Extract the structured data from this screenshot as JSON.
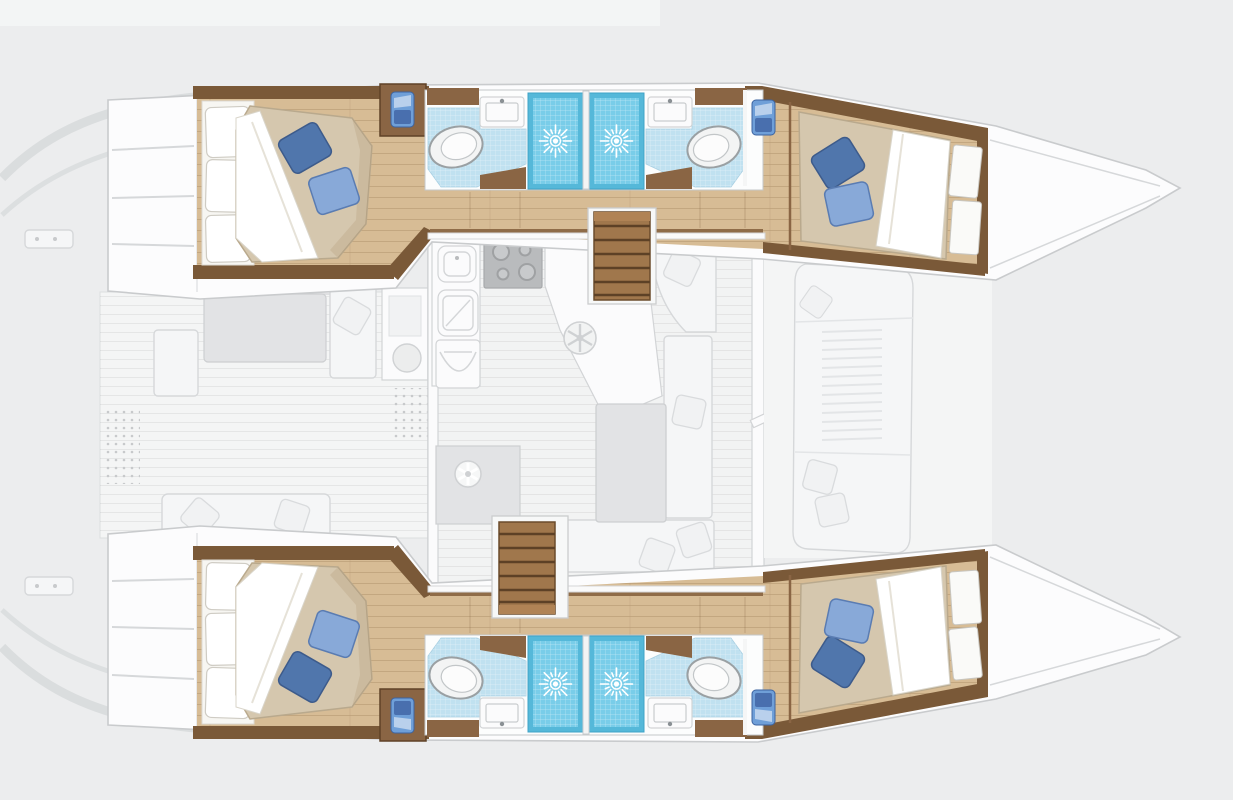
{
  "title": "Catamaran yacht floor plan",
  "palette": {
    "background": "#ecedee",
    "hull_white": "#fcfcfd",
    "hull_outline": "#c9cbcd",
    "ghost_fill": "#f5f6f7",
    "ghost_stroke": "#d6d8da",
    "ghost_dark": "#e2e3e5",
    "wood_floor": "#d7bc95",
    "wood_plank": "#a9835c",
    "wall_wood": "#7a5938",
    "cabinet_wood": "#8a6544",
    "stair_wood": "#a0774c",
    "stair_tread": "#5d4126",
    "mattress": "#d5c7ae",
    "mattress_edge": "#b9a98d",
    "sheet_white": "#ffffff",
    "pillow_dark_blue": "#5076ac",
    "pillow_light_blue": "#88a9d8",
    "bath_floor_blue": "#c0e1f0",
    "shower_blue": "#55b8d9",
    "shower_blue_light": "#79cde9",
    "fixture_white": "#f7f8f8",
    "fixture_stroke": "#9ba1a4",
    "towel_blue": "#6f9fd8",
    "towel_blue_dark": "#496fae",
    "table_gray": "#e2e3e5"
  },
  "layout": {
    "orientation": "bow to the right, stern to the left; two hulls top and bottom joined by bridge deck",
    "lower_deck_full_color": {
      "per_hull_rooms": [
        "aft double cabin with tan mattress, white folded sheet, one dark-blue and one light-blue pillow, white headboard pads, wardrobe with blue towel",
        "head with white sink counter, toilet on light-blue tiled floor",
        "two blue-tiled shower cubicles with sunburst drains",
        "second head mirrored with sink and toilet",
        "forward double cabin with tan mattress, two blue pillows, white sheet and shelf pads, blue towel at entry"
      ]
    },
    "main_deck_ghosted": [
      "aft cockpit with bench seating, gray table, scatter pillows and dotted mats",
      "galley with twin rounded sinks, four-burner stove, curved-front cabinet, diagonal counter with wheel hatch",
      "fridge unit with fan vent",
      "saloon with U-shaped white sofa, gray table and pillows",
      "navigation bench with pillow",
      "two companionway staircases with wooden treads",
      "foredeck lounge pad with slatted backrest and pillows",
      "stern swim steps and targa arch curves, pointed bows"
    ],
    "counts": {
      "cabins": 4,
      "toilets": 4,
      "showers": 4,
      "bathroom_sinks": 4,
      "staircases": 2,
      "blue_pillows_per_cabin": 2
    }
  }
}
